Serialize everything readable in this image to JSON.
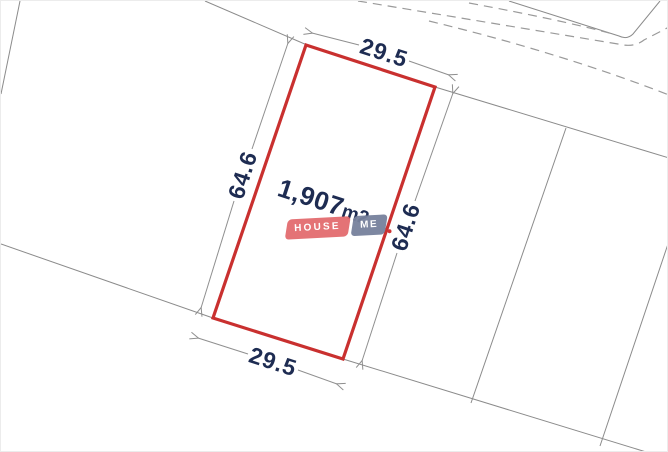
{
  "plot": {
    "area_value": "1,907",
    "area_unit": "m2",
    "dimensions": {
      "top": "29.5",
      "bottom": "29.5",
      "left": "64.6",
      "right": "64.6"
    },
    "outline_color": "#c9302f"
  },
  "watermark": {
    "brand_primary": "HOUSE",
    "brand_secondary": "ME",
    "primary_bg": "#e2686c",
    "secondary_bg": "#76819c",
    "dot_color": "#cf3434"
  },
  "colors": {
    "dimension_text": "#1e2c52",
    "parcel_line": "#8b8b8b",
    "dashed_line": "#9a9a9a"
  }
}
